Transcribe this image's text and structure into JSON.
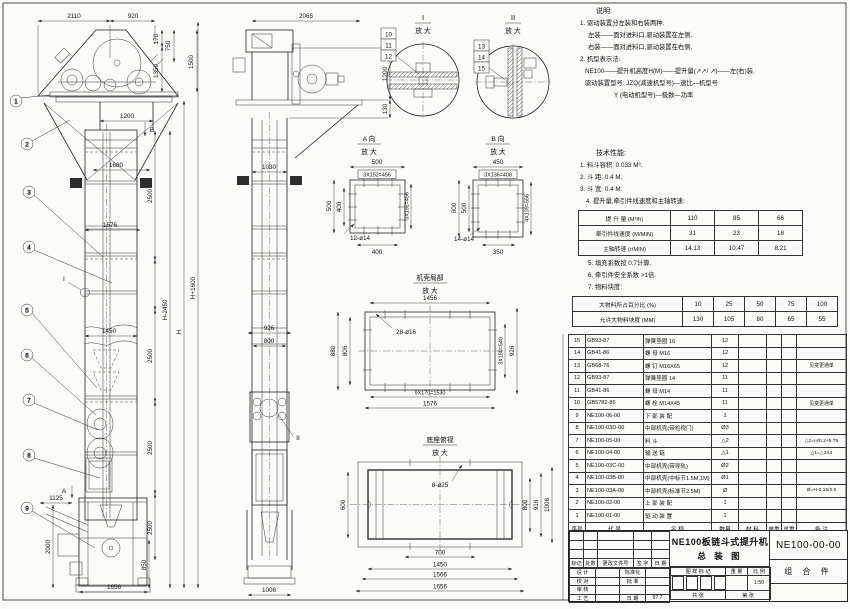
{
  "views": {
    "front": {
      "balloons": [
        "1",
        "2",
        "3",
        "4",
        "5",
        "6",
        "7",
        "8",
        "9"
      ],
      "markers": {
        "a": "A",
        "b": "B",
        "i": "I"
      },
      "dims": {
        "w2110": "2110",
        "w920": "920",
        "v170": "170",
        "v750": "750",
        "v1350": "1350",
        "v1500": "1500",
        "w1200": "1200",
        "w1680": "1680",
        "w1576": "1576",
        "w1450": "1450",
        "s2500a": "2500",
        "s2500b": "2500",
        "s2500c": "2500",
        "s2500d": "2500",
        "v850": "850",
        "hm": "H-2450",
        "h": "H",
        "hp": "H+1600",
        "w1125": "1125",
        "v2000": "2000",
        "w1656": "1656"
      }
    },
    "side": {
      "marker_ii": "II",
      "dims": {
        "w2065": "2065",
        "v1200": "1200",
        "v130": "130",
        "w1030": "1030",
        "w926": "926",
        "w800": "800",
        "w1006": "1006"
      }
    },
    "detail1": {
      "title": "I",
      "subtitle": "放 大",
      "callouts": [
        "10",
        "11",
        "12"
      ]
    },
    "detail2": {
      "title": "II",
      "subtitle": "放 大",
      "callouts": [
        "13",
        "14",
        "15"
      ]
    },
    "view_a": {
      "title": "A 向",
      "subtitle": "放 大",
      "dims": {
        "top": "500",
        "pitch": "3X152=456",
        "left_a": "500",
        "left_b": "400",
        "right": "3X152=456",
        "bottom": "400",
        "holes": "12-ø14"
      }
    },
    "view_b": {
      "title": "B 向",
      "subtitle": "放 大",
      "dims": {
        "top": "450",
        "pitch": "3X136=408",
        "left_a": "600",
        "left_b": "500",
        "right": "4X139=556",
        "bottom": "350",
        "holes": "14-ø14"
      }
    },
    "casing": {
      "title": "机壳局部",
      "subtitle": "放 大",
      "dims": {
        "top": "1456",
        "holes": "28-ø16",
        "left_a": "880",
        "left_b": "806",
        "right_a": "3X180=540",
        "right_b": "926",
        "bottom_a": "9X170=1530",
        "bottom_b": "1576"
      }
    },
    "base": {
      "title": "底座俯视",
      "subtitle": "放 大",
      "dims": {
        "holes": "8-ø25",
        "left": "600",
        "r800": "800",
        "r916": "916",
        "r1006": "1006",
        "b700": "700",
        "b1450": "1450",
        "b1566": "1566",
        "b1656": "1656"
      }
    }
  },
  "notes": {
    "heading": "说明:",
    "lines": [
      "1. 驱动装置分左装和右装两种.",
      "左装——面对进料口,驱动装置在左侧.",
      "右装——面对进料口,驱动装置在右侧.",
      "2. 机型表示法:",
      "NE100——提升机高度H(M)——提升量(↗↗/ ↗)——左(右)装.",
      "驱动装置型号: JZQ(减速机型号)—速比—机型号",
      "Y (电动机型号)—极数—功率"
    ]
  },
  "tech": {
    "heading": "技术性能:",
    "lines": [
      "1. 料斗容积: 0.033 M³.",
      "2. 斗  距: 0.4 M.",
      "3. 斗  宽: 0.4 M.",
      "4. 提升量,牵引件线速度和主轴转速:"
    ],
    "table1": [
      [
        "提 升 量 (M³/h)",
        "110",
        "85",
        "66"
      ],
      [
        "牵引件线速度 (M/MIN)",
        "31",
        "23",
        "18"
      ],
      [
        "主轴转速 (r/MIN)",
        "14.13",
        "10.47",
        "8.21"
      ]
    ],
    "lines2": [
      "5. 填充系数按 0.7计算.",
      "6. 牵引件安全系数 >1倍.",
      "7. 物料块度:"
    ],
    "table2": [
      [
        "大物料所占百分比 (%)",
        "10",
        "25",
        "50",
        "75",
        "100"
      ],
      [
        "允许大物料块度 (MM)",
        "130",
        "105",
        "80",
        "65",
        "55"
      ]
    ]
  },
  "parts": {
    "headers": [
      "序号",
      "代  号",
      "名  称",
      "数量",
      "材  料",
      "单重",
      "总重",
      "备  注"
    ],
    "rows": [
      {
        "no": "15",
        "code": "GB93-87",
        "name": "弹簧垫圈 16",
        "qty": "12",
        "mat": "",
        "unit": "",
        "total": "",
        "remark": ""
      },
      {
        "no": "14",
        "code": "GB41-86",
        "name": "螺 母 M16",
        "qty": "12",
        "mat": "",
        "unit": "",
        "total": "",
        "remark": ""
      },
      {
        "no": "13",
        "code": "GB68-76",
        "name": "螺 钉 M16X65",
        "qty": "12",
        "mat": "",
        "unit": "",
        "total": "",
        "remark": "见变更通单"
      },
      {
        "no": "12",
        "code": "GB93-87",
        "name": "弹簧垫圈 14",
        "qty": "11",
        "mat": "",
        "unit": "",
        "total": "",
        "remark": ""
      },
      {
        "no": "11",
        "code": "GB41-86",
        "name": "螺 母 M14",
        "qty": "11",
        "mat": "",
        "unit": "",
        "total": "",
        "remark": ""
      },
      {
        "no": "10",
        "code": "GB5782-86",
        "name": "螺 栓 M14X45",
        "qty": "11",
        "mat": "",
        "unit": "",
        "total": "",
        "remark": "见变更通单"
      },
      {
        "no": "9",
        "code": "NE100-06-00",
        "name": "下 部 装 配",
        "qty": "1",
        "mat": "",
        "unit": "",
        "total": "",
        "remark": ""
      },
      {
        "no": "8",
        "code": "NE100-03D-00",
        "name": "中部机壳(带检视门)",
        "qty": "Ø3",
        "mat": "",
        "unit": "",
        "total": "",
        "remark": ""
      },
      {
        "no": "7",
        "code": "NE100-05-00",
        "name": "料 斗",
        "qty": "△2",
        "mat": "",
        "unit": "",
        "total": "",
        "remark": "△2=H/0.2+5.75"
      },
      {
        "no": "6",
        "code": "NE100-04-00",
        "name": "输 送 链",
        "qty": "△1",
        "mat": "",
        "unit": "",
        "total": "",
        "remark": "△1=△2X4"
      },
      {
        "no": "5",
        "code": "NE100-03C-00",
        "name": "中部机壳(带导轨)",
        "qty": "Ø2",
        "mat": "",
        "unit": "",
        "total": "",
        "remark": ""
      },
      {
        "no": "4",
        "code": "NE100-03B-00",
        "name": "中部机壳(中标节1.5M,1M)",
        "qty": "Ø1",
        "mat": "",
        "unit": "",
        "total": "",
        "remark": ""
      },
      {
        "no": "3",
        "code": "NE100-03A-00",
        "name": "中部机壳(标准节2.5M)",
        "qty": "Ø",
        "mat": "",
        "unit": "",
        "total": "",
        "remark": "Ø=H-3.15/2.5"
      },
      {
        "no": "2",
        "code": "NE100-02-00",
        "name": "上 部 装 配",
        "qty": "1",
        "mat": "",
        "unit": "",
        "total": "",
        "remark": ""
      },
      {
        "no": "1",
        "code": "NE100-01-00",
        "name": "驱 动 装 置",
        "qty": "1",
        "mat": "",
        "unit": "",
        "total": "",
        "remark": ""
      }
    ]
  },
  "titleblock": {
    "title1": "NE100板链斗式提升机",
    "title2": "总 装 图",
    "code": "NE100-00-00",
    "type": "组 合 件",
    "rev": [
      "标记",
      "处数",
      "更改文件号",
      "签 字",
      "日 期"
    ],
    "sig": [
      [
        "设 计",
        "",
        "标准化",
        ""
      ],
      [
        "校 对",
        "",
        "批 准",
        ""
      ],
      [
        "审 核",
        "",
        "",
        ""
      ],
      [
        "工 艺",
        "",
        "日 期",
        "97.7"
      ]
    ],
    "stamp": [
      "图 样 标 记",
      "重 量",
      "比 例"
    ],
    "scale": "1:50",
    "sheet": [
      "共  张",
      "第  张"
    ]
  }
}
